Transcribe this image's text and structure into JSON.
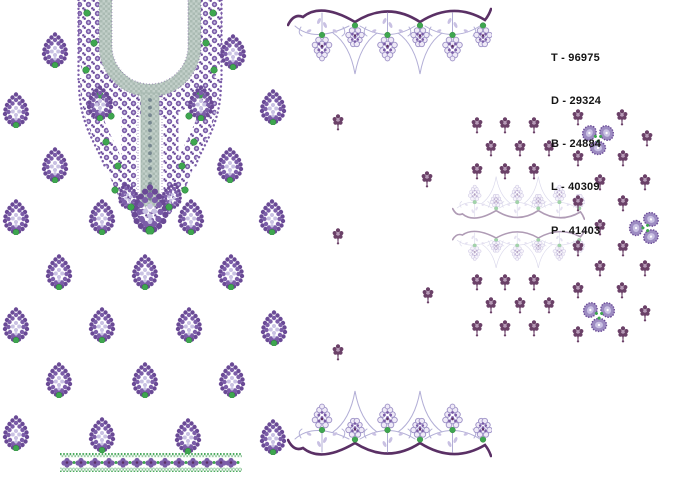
{
  "sheet": {
    "kind": "embroidery-design-sheet"
  },
  "stitch_info": {
    "lines": [
      "T - 96975",
      "D - 29324",
      "B - 24884",
      "L - 40309",
      "P - 41403"
    ]
  },
  "colors": {
    "purple": "#7b5da8",
    "purple_deep": "#6a4a96",
    "arc": "#5a3065",
    "lav": "#c9c1e3",
    "lav_line": "#b2aed6",
    "green": "#3ea64f",
    "gray_band": "#c2cfc9",
    "gray_band_dark": "#aabbb3",
    "plum": "#6b4168",
    "plum_light": "#b79ab8",
    "text": "#141414",
    "background": "#ffffff"
  },
  "motifs": {
    "paisleys": [
      [
        55,
        50
      ],
      [
        233,
        52
      ],
      [
        16,
        110
      ],
      [
        100,
        103
      ],
      [
        201,
        103
      ],
      [
        273,
        107
      ],
      [
        55,
        165
      ],
      [
        230,
        165
      ],
      [
        16,
        217
      ],
      [
        102,
        217
      ],
      [
        191,
        217
      ],
      [
        272,
        217
      ],
      [
        59,
        272
      ],
      [
        145,
        272
      ],
      [
        231,
        272
      ],
      [
        16,
        325
      ],
      [
        102,
        325
      ],
      [
        189,
        325
      ],
      [
        274,
        328
      ],
      [
        59,
        380
      ],
      [
        145,
        380
      ],
      [
        232,
        380
      ],
      [
        16,
        433
      ],
      [
        102,
        435
      ],
      [
        188,
        436
      ],
      [
        273,
        437
      ]
    ],
    "butis": [
      [
        338,
        122
      ],
      [
        427,
        179
      ],
      [
        338,
        236
      ],
      [
        428,
        295
      ],
      [
        338,
        352
      ],
      [
        477,
        125
      ],
      [
        505,
        125
      ],
      [
        534,
        125
      ],
      [
        491,
        148
      ],
      [
        520,
        148
      ],
      [
        549,
        148
      ],
      [
        477,
        171
      ],
      [
        505,
        171
      ],
      [
        534,
        171
      ],
      [
        477,
        282
      ],
      [
        505,
        282
      ],
      [
        534,
        282
      ],
      [
        491,
        305
      ],
      [
        520,
        305
      ],
      [
        549,
        305
      ],
      [
        477,
        328
      ],
      [
        505,
        328
      ],
      [
        534,
        328
      ],
      [
        578,
        117
      ],
      [
        622,
        117
      ],
      [
        647,
        138
      ],
      [
        578,
        158
      ],
      [
        623,
        158
      ],
      [
        600,
        182
      ],
      [
        645,
        182
      ],
      [
        578,
        203
      ],
      [
        623,
        203
      ],
      [
        600,
        227
      ],
      [
        578,
        248
      ],
      [
        623,
        248
      ],
      [
        600,
        268
      ],
      [
        645,
        268
      ],
      [
        578,
        290
      ],
      [
        622,
        290
      ],
      [
        645,
        313
      ],
      [
        578,
        334
      ],
      [
        623,
        334
      ]
    ],
    "trefoils": [
      [
        598,
        138,
        60
      ],
      [
        646,
        228,
        30
      ],
      [
        599,
        315,
        60
      ]
    ]
  },
  "borders": {
    "top": {
      "x": 287,
      "y": 3,
      "width": 205,
      "height": 78,
      "flipped": false
    },
    "bottom": {
      "x": 287,
      "y": 462,
      "width": 205,
      "height": 78,
      "flipped": true
    },
    "faded_top": {
      "x": 452,
      "y": 223,
      "width": 133,
      "height": 51,
      "flipped": true
    },
    "faded_bottom": {
      "x": 452,
      "y": 227,
      "width": 133,
      "height": 45,
      "flipped": false
    },
    "green_strip": {
      "x": 60,
      "y": 453,
      "width": 182,
      "height": 19
    }
  }
}
